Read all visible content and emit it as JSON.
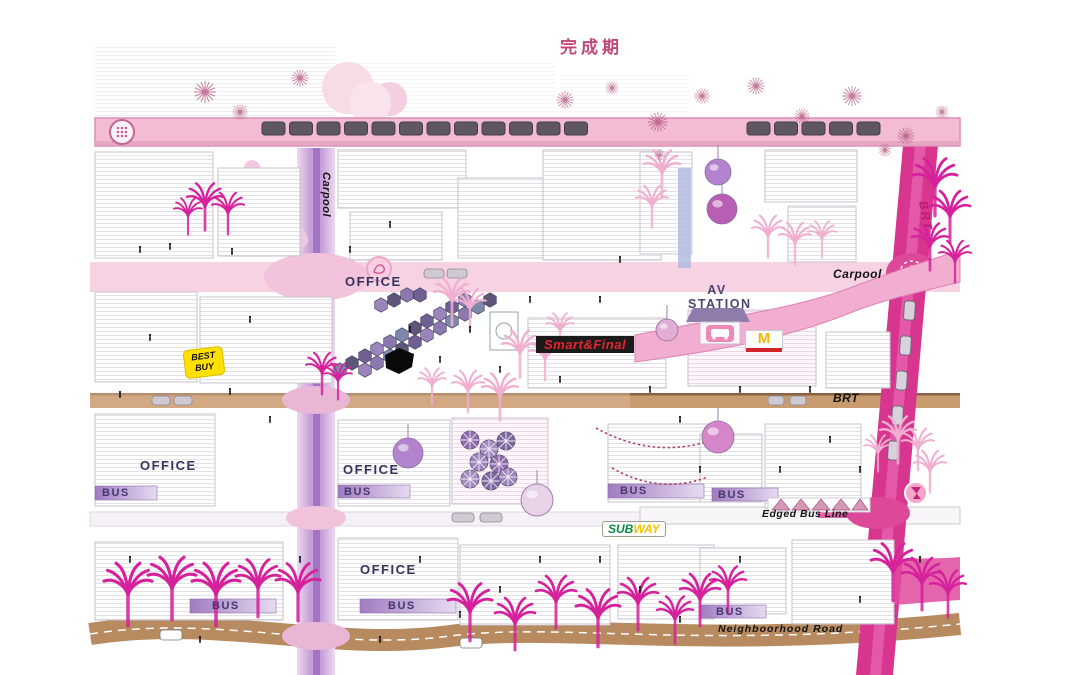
{
  "title": "完成期",
  "labels": {
    "carpool_left": "Carpool",
    "carpool_right": "Carpool",
    "brt_vertical": "BRT",
    "brt_horizontal": "BRT",
    "edged_bus_line": "Edged Bus Line",
    "neighborhood_road": "Neighboorhood Road",
    "av_line1": "AV",
    "av_line2": "STATION",
    "office_top": "OFFICE",
    "office_mid_left": "OFFICE",
    "office_mid_center": "OFFICE",
    "office_bottom": "OFFICE",
    "bus_mid_left": "BUS",
    "bus_mid_center": "BUS",
    "bus_mid_east": "BUS",
    "bus_mid_far_east": "BUS",
    "bus_bottom_left": "BUS",
    "bus_bottom_center": "BUS",
    "bus_bottom_east": "BUS"
  },
  "signs": {
    "smart_final": "Smart&Final",
    "best_buy_line1": "BEST",
    "best_buy_line2": "BUY",
    "subway_sub": "SUB",
    "subway_way": "WAY",
    "mcdonalds_m": "M"
  },
  "icons": {
    "rail_emblem": "metro-line-badge",
    "station_sign": "bus-stop-sign",
    "plaza_poi": "flower-badge",
    "east_poi": "landmark-badge"
  },
  "transit": {
    "left_train_cars": 12,
    "right_train_cars": 5,
    "east_road_buses": 5
  },
  "colors": {
    "title_pink": "#c2487c",
    "rail_pink": "#f3bcd3",
    "road_magenta": "#d8358f",
    "carpool_band": "#f6d2e3",
    "brt_tan": "#c99c6f",
    "neighborhood_brown": "#b78a5f",
    "palm_magenta": "#d6219c",
    "palm_light_pink": "#f0aed0",
    "office_text": "#35335c",
    "bus_text": "#43386f",
    "best_buy_yellow": "#ffe000",
    "smart_final_red": "#e8232e",
    "subway_green": "#0a8a43",
    "subway_yellow": "#f4c400",
    "mcdonalds_gold": "#f7b500"
  }
}
